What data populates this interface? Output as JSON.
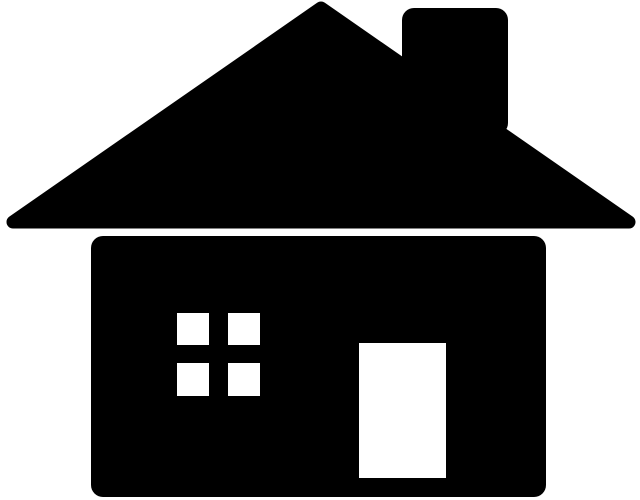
{
  "image": {
    "description": "Black silhouette pictogram of a house with a triangular roof, chimney, four-pane window and a door",
    "background_color": "#ffffff",
    "foreground_color": "#000000",
    "canvas": {
      "width": 640,
      "height": 500
    },
    "shapes": {
      "roof": {
        "type": "polygon",
        "points": [
          [
            13,
            222
          ],
          [
            321,
            8
          ],
          [
            629,
            222
          ]
        ],
        "corner_stroke_width": 13
      },
      "chimney": {
        "type": "rect",
        "x": 402,
        "y": 8,
        "width": 106,
        "height": 127,
        "rx": 12
      },
      "house_body": {
        "type": "rect",
        "x": 91,
        "y": 236,
        "width": 455,
        "height": 261,
        "rx": 12
      },
      "door": {
        "type": "rect",
        "x": 359,
        "y": 343,
        "width": 87,
        "height": 135,
        "rx": 0,
        "color": "#ffffff"
      },
      "window_panes": [
        {
          "x": 177,
          "y": 313,
          "width": 32,
          "height": 32
        },
        {
          "x": 228,
          "y": 313,
          "width": 32,
          "height": 32
        },
        {
          "x": 177,
          "y": 363,
          "width": 32,
          "height": 33
        },
        {
          "x": 228,
          "y": 363,
          "width": 32,
          "height": 33
        }
      ],
      "pane_color": "#ffffff"
    }
  }
}
